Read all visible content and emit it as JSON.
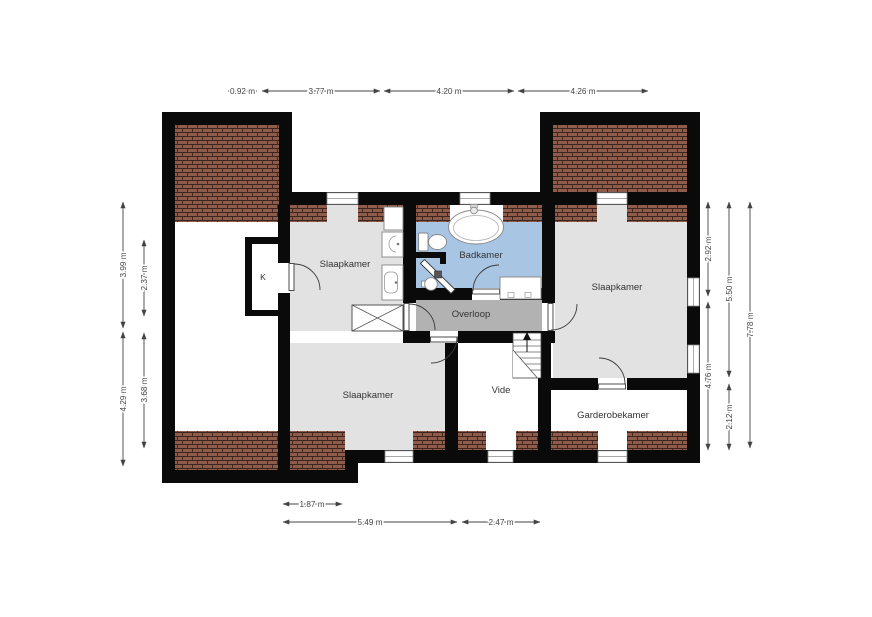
{
  "rooms": {
    "slaapkamer_nw": "Slaapkamer",
    "badkamer": "Badkamer",
    "slaapkamer_e": "Slaapkamer",
    "overloop": "Overloop",
    "slaapkamer_sw": "Slaapkamer",
    "vide": "Vide",
    "garderobekamer": "Garderobekamer",
    "kast": "K"
  },
  "dims": {
    "top": [
      "0.92 m",
      "3.77 m",
      "4.20 m",
      "4.26 m"
    ],
    "left_outer": [
      "3.99 m",
      "4.29 m"
    ],
    "left_inner": [
      "2.37 m",
      "3.68 m"
    ],
    "right_inner": [
      "2.92 m",
      "4.76 m"
    ],
    "right_middle": [
      "5.50 m",
      "2.12 m"
    ],
    "right_outer": [
      "7.78 m"
    ],
    "bottom_inner": [
      "1.87 m"
    ],
    "bottom_outer": [
      "5.49 m",
      "2.47 m"
    ]
  },
  "colors": {
    "wall": "#0a0a0a",
    "room_floor": "#e2e2e2",
    "landing_floor": "#b2b2b2",
    "bathroom_floor": "#a9c5e4",
    "roof_tile": "#8e5c4b",
    "roof_grout": "#3d241c"
  }
}
